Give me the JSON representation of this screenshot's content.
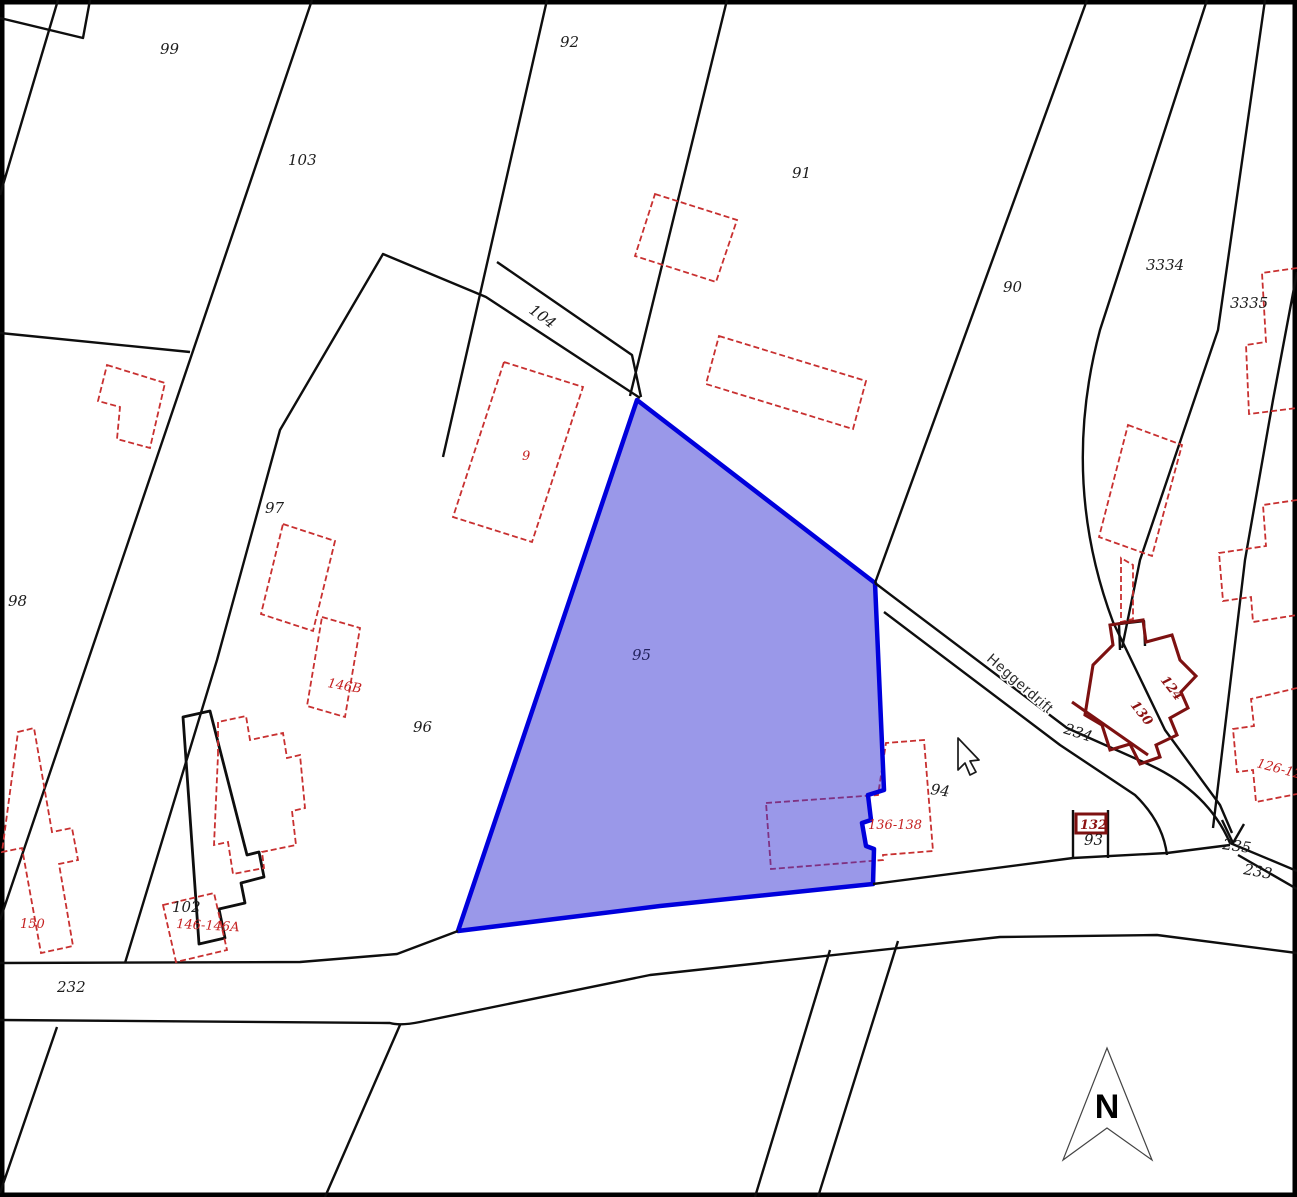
{
  "map": {
    "background": "#ffffff",
    "accent_highlight_fill": "#9696eb",
    "accent_highlight_stroke": "#0000dc",
    "building_color": "#c83030",
    "building_bold_color": "#7d1111",
    "selected_parcel": {
      "number": "95",
      "path": "M637,400 L875,583 L884,790 L868,795 L871,820 L862,823 L866,846 L874,849 L873,884 L660,906 L458,931 Z"
    },
    "street": {
      "name": "Heggerdrift",
      "x": 986,
      "y": 660,
      "rotation": 41
    },
    "north_arrow": {
      "label": "N",
      "points": "1107,1048 1152,1160 1107,1128 1063,1160",
      "label_x": 1107,
      "label_y": 1118
    },
    "cursor": {
      "path": "M958,738 L958,770 L965,763 L970,775 L976,772 L970,761 L979,760 Z"
    },
    "parcel_labels": [
      {
        "text": "99",
        "x": 160,
        "y": 54,
        "rot": 0,
        "cls": "lbl-black"
      },
      {
        "text": "103",
        "x": 288,
        "y": 165,
        "rot": 0,
        "cls": "lbl-black"
      },
      {
        "text": "92",
        "x": 560,
        "y": 47,
        "rot": 0,
        "cls": "lbl-black"
      },
      {
        "text": "91",
        "x": 792,
        "y": 178,
        "rot": 0,
        "cls": "lbl-black"
      },
      {
        "text": "90",
        "x": 1003,
        "y": 292,
        "rot": 0,
        "cls": "lbl-black"
      },
      {
        "text": "3334",
        "x": 1146,
        "y": 270,
        "rot": 0,
        "cls": "lbl-black"
      },
      {
        "text": "3335",
        "x": 1230,
        "y": 308,
        "rot": 0,
        "cls": "lbl-black"
      },
      {
        "text": "104",
        "x": 528,
        "y": 312,
        "rot": 36,
        "cls": "lbl-black"
      },
      {
        "text": "97",
        "x": 265,
        "y": 513,
        "rot": 0,
        "cls": "lbl-black"
      },
      {
        "text": "98",
        "x": 8,
        "y": 606,
        "rot": 0,
        "cls": "lbl-black"
      },
      {
        "text": "96",
        "x": 413,
        "y": 732,
        "rot": 0,
        "cls": "lbl-black"
      },
      {
        "text": "95",
        "x": 632,
        "y": 660,
        "rot": 0,
        "cls": "lbl-blue"
      },
      {
        "text": "94",
        "x": 930,
        "y": 794,
        "rot": 8,
        "cls": "lbl-black"
      },
      {
        "text": "93",
        "x": 1084,
        "y": 845,
        "rot": 0,
        "cls": "lbl-black"
      },
      {
        "text": "102",
        "x": 172,
        "y": 912,
        "rot": 0,
        "cls": "lbl-black"
      },
      {
        "text": "232",
        "x": 57,
        "y": 992,
        "rot": 0,
        "cls": "lbl-black"
      },
      {
        "text": "233",
        "x": 1243,
        "y": 874,
        "rot": 10,
        "cls": "lbl-black"
      },
      {
        "text": "234",
        "x": 1063,
        "y": 733,
        "rot": 18,
        "cls": "lbl-black"
      },
      {
        "text": "235",
        "x": 1222,
        "y": 849,
        "rot": 8,
        "cls": "lbl-black"
      }
    ],
    "building_labels": [
      {
        "text": "9",
        "x": 522,
        "y": 460,
        "rot": 0,
        "cls": "lbl-red"
      },
      {
        "text": "146B",
        "x": 327,
        "y": 687,
        "rot": 10,
        "cls": "lbl-red"
      },
      {
        "text": "150",
        "x": 20,
        "y": 928,
        "rot": 0,
        "cls": "lbl-red"
      },
      {
        "text": "146-146A",
        "x": 176,
        "y": 928,
        "rot": 3,
        "cls": "lbl-red"
      },
      {
        "text": "136-138",
        "x": 868,
        "y": 829,
        "rot": 0,
        "cls": "lbl-red"
      },
      {
        "text": "126-128",
        "x": 1256,
        "y": 767,
        "rot": 15,
        "cls": "lbl-red"
      },
      {
        "text": "124",
        "x": 1160,
        "y": 680,
        "rot": 52,
        "cls": "lbl-maroon"
      },
      {
        "text": "130",
        "x": 1130,
        "y": 705,
        "rot": 52,
        "cls": "lbl-maroon"
      },
      {
        "text": "132",
        "x": 1080,
        "y": 829,
        "rot": 0,
        "cls": "lbl-maroon"
      }
    ],
    "parcel_lines": [
      {
        "name": "map-border",
        "d": "M2,2 H1295 V1195 H2 Z",
        "cls": "ln-border"
      },
      {
        "name": "boundary-topleft-notch",
        "d": "M0,18 L83,38 L90,0"
      },
      {
        "name": "boundary-topleft",
        "d": "M58,0 L0,195"
      },
      {
        "name": "boundary-98-99",
        "d": "M312,0 L0,920"
      },
      {
        "name": "boundary-98-upper",
        "d": "M0,333 L190,352"
      },
      {
        "name": "boundary-96-block",
        "d": "M125,963 L217,660 L280,430 L383,254 L486,297 L640,398"
      },
      {
        "name": "boundary-104-strip",
        "d": "M497,262 L632,355 L641,397"
      },
      {
        "name": "boundary-103-92",
        "d": "M547,0 L443,457"
      },
      {
        "name": "boundary-92-91",
        "d": "M727,0 L630,396"
      },
      {
        "name": "boundary-91-90",
        "d": "M1087,0 L875,583"
      },
      {
        "name": "boundary-90-3334",
        "d": "M1207,0 L1100,330 Q1060,480 1113,622 L1165,730 L1220,805 L1232,833"
      },
      {
        "name": "boundary-3334-3335",
        "d": "M1265,0 L1218,330 L1140,560 L1122,648"
      },
      {
        "name": "boundary-right-edge",
        "d": "M1297,272 L1273,400 L1245,560 L1213,828"
      },
      {
        "name": "road-234-nw-edge",
        "d": "M875,583 L1067,728 L1150,765 Q1208,792 1230,843"
      },
      {
        "name": "road-234-se-edge",
        "d": "M884,612 L1060,745 L1135,795 Q1163,822 1167,855"
      },
      {
        "name": "road-232-upper-left",
        "d": "M0,963 L300,962 L397,954 L458,931"
      },
      {
        "name": "road-232-upper-right",
        "d": "M873,884 L1073,858 L1167,853 L1230,845"
      },
      {
        "name": "road-232-lower",
        "d": "M0,1020 L390,1023 Q400,1026 420,1022 L650,975 L1000,937 L1157,935 L1297,953"
      },
      {
        "name": "boundary-below-road-1",
        "d": "M57,1027 L0,1193"
      },
      {
        "name": "boundary-below-road-2",
        "d": "M400,1025 L325,1197"
      },
      {
        "name": "boundary-below-road-3",
        "d": "M830,950 L755,1197"
      },
      {
        "name": "boundary-below-road-4",
        "d": "M898,941 L818,1197"
      },
      {
        "name": "road-fork-235",
        "d": "M1230,843 L1297,871"
      },
      {
        "name": "road-fork-233",
        "d": "M1238,855 L1297,889"
      },
      {
        "name": "road-fork-tick",
        "d": "M1222,820 L1233,843 L1244,824"
      },
      {
        "name": "parcel-93-left",
        "d": "M1073,858 L1073,810"
      },
      {
        "name": "parcel-93-right",
        "d": "M1108,858 L1108,810"
      },
      {
        "name": "building-bracket",
        "d": "M1120,650 L1119,624 L1144,621 L1145,646"
      },
      {
        "name": "building-102-outline",
        "d": "M183,717 L210,711 L247,855 L259,852 L264,877 L241,883 L245,903 L219,909 L225,938 L199,944 Z",
        "cls": "ln-thickblack"
      }
    ],
    "buildings_under_highlight": [
      {
        "name": "building-136-138",
        "d": "M766,803 L878,795 L886,743 L924,740 L933,851 L883,855 L883,860 L771,869 Z"
      }
    ],
    "buildings_red": [
      {
        "name": "building-103-L",
        "d": "M107,365 L165,383 L150,448 L117,439 L120,407 L98,401 Z"
      },
      {
        "name": "building-97",
        "d": "M283,524 L335,541 L313,631 L261,614 Z"
      },
      {
        "name": "building-146B",
        "d": "M322,617 L360,628 L345,717 L307,706 Z"
      },
      {
        "name": "building-9",
        "d": "M504,362 L583,387 L532,542 L453,517 Z"
      },
      {
        "name": "building-91-upper",
        "d": "M655,194 L737,220 L716,282 L635,256 Z"
      },
      {
        "name": "building-91-lower",
        "d": "M719,336 L866,381 L853,429 L706,384 Z"
      },
      {
        "name": "building-150",
        "d": "M18,732 L34,728 L52,832 L72,828 L78,860 L59,864 L73,946 L41,953 L22,848 L2,852 Z"
      },
      {
        "name": "building-102-cluster",
        "d": "M218,755 L218,722 L246,716 L250,740 L283,733 L287,758 L300,755 L305,808 L292,811 L296,845 L262,852 L264,868 L233,874 L228,842 L214,845 Z"
      },
      {
        "name": "building-146-146A",
        "d": "M163,905 L214,893 L227,950 L176,962 Z"
      },
      {
        "name": "building-ne-rect",
        "d": "M1128,425 L1182,445 L1152,556 L1099,537 Z"
      },
      {
        "name": "building-ne-connector",
        "d": "M1121,558 L1121,622 L1133,619 L1133,565 Z"
      },
      {
        "name": "building-right-upper",
        "d": "M1297,268 L1262,273 L1266,342 L1246,345 L1249,414 L1297,408"
      },
      {
        "name": "building-right-mid",
        "d": "M1297,500 L1263,505 L1266,546 L1219,553 L1223,601 L1251,597 L1253,622 L1297,615"
      },
      {
        "name": "building-126-128",
        "d": "M1297,688 L1251,699 L1254,726 L1233,729 L1237,772 L1253,770 L1256,802 L1297,794"
      }
    ],
    "buildings_maroon": [
      {
        "name": "building-124-130-wall",
        "d": "M1072,702 L1148,755"
      },
      {
        "name": "building-124-130-cluster",
        "d": "M1093,665 L1113,645 L1110,625 L1143,620 L1146,642 L1172,635 L1180,660 L1196,676 L1181,692 L1188,708 L1170,718 L1177,735 L1156,745 L1160,757 L1140,764 L1130,744 L1110,750 L1102,725 L1085,715 Z"
      },
      {
        "name": "building-132-box",
        "d": "M1076,814 L1106,814 L1106,833 L1076,833 Z"
      }
    ]
  }
}
